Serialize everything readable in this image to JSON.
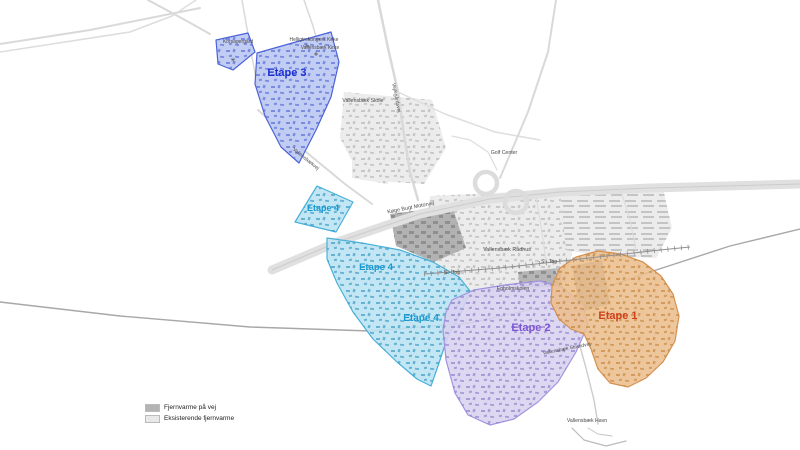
{
  "map": {
    "background": "#ffffff",
    "legend": {
      "items": [
        {
          "label": "Fjernvarme på vej",
          "color": "#b4b4b4"
        },
        {
          "label": "Eksisterende fjernvarme",
          "color": "#e9e9e9"
        }
      ]
    },
    "gray_areas": [
      {
        "name": "skole-area",
        "fill": "#ececec",
        "pattern": "patGray",
        "points": [
          [
            344,
            92
          ],
          [
            432,
            100
          ],
          [
            446,
            148
          ],
          [
            424,
            184
          ],
          [
            362,
            180
          ],
          [
            340,
            138
          ]
        ]
      },
      {
        "name": "central-area",
        "fill": "#ececec",
        "pattern": "patGray",
        "points": [
          [
            430,
            196
          ],
          [
            562,
            190
          ],
          [
            576,
            232
          ],
          [
            566,
            282
          ],
          [
            540,
            296
          ],
          [
            472,
            298
          ],
          [
            440,
            272
          ],
          [
            426,
            232
          ]
        ]
      },
      {
        "name": "east-area",
        "fill": "#ececec",
        "pattern": "patGrayRows",
        "points": [
          [
            560,
            190
          ],
          [
            662,
            184
          ],
          [
            672,
            228
          ],
          [
            656,
            258
          ],
          [
            600,
            256
          ],
          [
            566,
            250
          ]
        ]
      },
      {
        "name": "kirke-area",
        "fill": "#ededed",
        "pattern": "patGray",
        "points": [
          [
            352,
            150
          ],
          [
            392,
            160
          ],
          [
            388,
            184
          ],
          [
            352,
            178
          ]
        ]
      }
    ],
    "dark_areas": [
      {
        "name": "motorway-north-blocks",
        "fill": "#b2b2b2",
        "pattern": "patDark",
        "points": [
          [
            390,
            214
          ],
          [
            452,
            206
          ],
          [
            466,
            248
          ],
          [
            434,
            262
          ],
          [
            396,
            246
          ]
        ]
      },
      {
        "name": "orange-inner-block",
        "fill": "#9b9b9b",
        "pattern": "patDark",
        "points": [
          [
            572,
            266
          ],
          [
            602,
            260
          ],
          [
            610,
            304
          ],
          [
            580,
            312
          ]
        ]
      },
      {
        "name": "station-blocks",
        "fill": "#b5b5b5",
        "pattern": "patDark",
        "points": [
          [
            518,
            272
          ],
          [
            560,
            268
          ],
          [
            562,
            286
          ],
          [
            520,
            288
          ]
        ]
      }
    ],
    "roads": [
      {
        "name": "top-left-road-a",
        "w": 2,
        "c": "#d9d9d9",
        "pts": [
          [
            0,
            44
          ],
          [
            90,
            30
          ],
          [
            200,
            8
          ]
        ]
      },
      {
        "name": "top-left-road-b",
        "w": 2,
        "c": "#d9d9d9",
        "pts": [
          [
            148,
            0
          ],
          [
            185,
            20
          ],
          [
            210,
            34
          ]
        ]
      },
      {
        "name": "top-left-road-c",
        "w": 1.5,
        "c": "#dddddd",
        "pts": [
          [
            196,
            0
          ],
          [
            172,
            16
          ],
          [
            130,
            32
          ],
          [
            0,
            52
          ]
        ]
      },
      {
        "name": "north-road-1",
        "w": 1.5,
        "c": "#d9d9d9",
        "pts": [
          [
            242,
            0
          ],
          [
            249,
            40
          ],
          [
            258,
            90
          ],
          [
            268,
            118
          ]
        ]
      },
      {
        "name": "north-road-2",
        "w": 1.5,
        "c": "#d9d9d9",
        "pts": [
          [
            304,
            0
          ],
          [
            313,
            26
          ],
          [
            318,
            44
          ]
        ]
      },
      {
        "name": "vejlegaardsvej-road",
        "w": 2.5,
        "c": "#d9d9d9",
        "pts": [
          [
            378,
            0
          ],
          [
            388,
            48
          ],
          [
            398,
            92
          ],
          [
            404,
            135
          ],
          [
            410,
            172
          ],
          [
            418,
            200
          ]
        ]
      },
      {
        "name": "branch-east-road",
        "w": 1.5,
        "c": "#dedede",
        "pts": [
          [
            398,
            92
          ],
          [
            445,
            114
          ],
          [
            495,
            132
          ],
          [
            540,
            140
          ]
        ]
      },
      {
        "name": "vallensbaekvej-road",
        "w": 2,
        "c": "#d9d9d9",
        "pts": [
          [
            258,
            110
          ],
          [
            300,
            147
          ],
          [
            345,
            184
          ],
          [
            372,
            204
          ]
        ]
      },
      {
        "name": "motorway-band",
        "w": 9,
        "c": "#e0e0e0",
        "pts": [
          [
            272,
            270
          ],
          [
            340,
            241
          ],
          [
            420,
            214
          ],
          [
            490,
            199
          ],
          [
            560,
            192
          ],
          [
            650,
            188
          ],
          [
            800,
            184
          ]
        ]
      },
      {
        "name": "motorway-median",
        "w": 1,
        "c": "#cccccc",
        "pts": [
          [
            272,
            270
          ],
          [
            340,
            241
          ],
          [
            420,
            214
          ],
          [
            490,
            199
          ],
          [
            560,
            192
          ],
          [
            650,
            188
          ],
          [
            800,
            184
          ]
        ]
      },
      {
        "name": "interchange-north-road",
        "w": 2,
        "c": "#d9d9d9",
        "pts": [
          [
            500,
            178
          ],
          [
            528,
            112
          ],
          [
            548,
            52
          ],
          [
            556,
            0
          ]
        ]
      },
      {
        "name": "golf-road",
        "w": 1.2,
        "c": "#dddddd",
        "pts": [
          [
            497,
            170
          ],
          [
            488,
            152
          ],
          [
            470,
            140
          ],
          [
            452,
            136
          ]
        ]
      },
      {
        "name": "coast-arc-road",
        "w": 1.4,
        "c": "#a8a8a8",
        "pts": [
          [
            0,
            302
          ],
          [
            120,
            316
          ],
          [
            250,
            327
          ],
          [
            370,
            331
          ],
          [
            470,
            323
          ],
          [
            560,
            303
          ],
          [
            650,
            272
          ],
          [
            730,
            246
          ],
          [
            800,
            229
          ]
        ]
      },
      {
        "name": "harbor-road",
        "w": 1.4,
        "c": "#cccccc",
        "pts": [
          [
            556,
            270
          ],
          [
            572,
            318
          ],
          [
            586,
            368
          ],
          [
            594,
            400
          ],
          [
            598,
            424
          ]
        ]
      },
      {
        "name": "harbor-quay-a",
        "w": 1.2,
        "c": "#bbbbbb",
        "pts": [
          [
            572,
            428
          ],
          [
            584,
            440
          ],
          [
            606,
            446
          ],
          [
            626,
            441
          ]
        ]
      },
      {
        "name": "harbor-quay-b",
        "w": 1,
        "c": "#c4c4c4",
        "pts": [
          [
            588,
            428
          ],
          [
            598,
            434
          ],
          [
            612,
            436
          ]
        ]
      },
      {
        "name": "radhus-road",
        "w": 1.2,
        "c": "#dddddd",
        "pts": [
          [
            536,
            196
          ],
          [
            542,
            232
          ],
          [
            546,
            262
          ]
        ]
      },
      {
        "name": "east-road",
        "w": 1.2,
        "c": "#dddddd",
        "pts": [
          [
            620,
            188
          ],
          [
            630,
            220
          ],
          [
            636,
            250
          ]
        ]
      }
    ],
    "interchange_loops": [
      {
        "cx": 486,
        "cy": 183,
        "r": 11
      },
      {
        "cx": 516,
        "cy": 202,
        "r": 11
      }
    ],
    "railway": {
      "name": "s-tog-line",
      "pts": [
        [
          424,
          274
        ],
        [
          500,
          268
        ],
        [
          580,
          259
        ],
        [
          660,
          250
        ],
        [
          690,
          247
        ]
      ],
      "color": "#909090"
    },
    "zones": [
      {
        "name": "etape-3-north",
        "fill": "#b9c6f2",
        "stroke": "#4a63d8",
        "pattern": "patBlue",
        "points": [
          [
            216,
            40
          ],
          [
            248,
            33
          ],
          [
            255,
            52
          ],
          [
            233,
            70
          ],
          [
            218,
            64
          ]
        ],
        "labels": []
      },
      {
        "name": "etape-3",
        "fill": "#b9c6f2",
        "stroke": "#4a63d8",
        "pattern": "patBlue",
        "points": [
          [
            257,
            53
          ],
          [
            331,
            32
          ],
          [
            339,
            62
          ],
          [
            331,
            97
          ],
          [
            316,
            130
          ],
          [
            299,
            163
          ],
          [
            281,
            147
          ],
          [
            265,
            116
          ],
          [
            255,
            84
          ]
        ],
        "labels": [
          {
            "text": "Etape 3",
            "x": 287,
            "y": 76,
            "size": 11,
            "color": "#1b2fd0"
          }
        ]
      },
      {
        "name": "etape-4-west",
        "fill": "#b9e3f3",
        "stroke": "#49b0d8",
        "pattern": "patCyan",
        "points": [
          [
            317,
            186
          ],
          [
            353,
            202
          ],
          [
            336,
            232
          ],
          [
            295,
            222
          ]
        ],
        "labels": [
          {
            "text": "Etape 4",
            "x": 323,
            "y": 211,
            "size": 9,
            "color": "#1899d1"
          }
        ]
      },
      {
        "name": "etape-4-main",
        "fill": "#b9e3f3",
        "stroke": "#49b0d8",
        "pattern": "patCyan",
        "points": [
          [
            327,
            238
          ],
          [
            362,
            243
          ],
          [
            400,
            250
          ],
          [
            433,
            262
          ],
          [
            459,
            277
          ],
          [
            470,
            291
          ],
          [
            461,
            313
          ],
          [
            447,
            339
          ],
          [
            439,
            363
          ],
          [
            431,
            386
          ],
          [
            417,
            379
          ],
          [
            397,
            362
          ],
          [
            373,
            339
          ],
          [
            353,
            312
          ],
          [
            337,
            283
          ],
          [
            327,
            259
          ]
        ],
        "labels": [
          {
            "text": "Etape 4",
            "x": 376,
            "y": 270,
            "size": 9.5,
            "color": "#1899d1"
          },
          {
            "text": "Etape 4",
            "x": 421,
            "y": 321,
            "size": 10,
            "color": "#1899d1"
          }
        ]
      },
      {
        "name": "etape-2",
        "fill": "#d8d2f0",
        "stroke": "#a193e0",
        "pattern": "patPurple",
        "points": [
          [
            452,
            300
          ],
          [
            474,
            290
          ],
          [
            505,
            285
          ],
          [
            540,
            281
          ],
          [
            562,
            287
          ],
          [
            583,
            305
          ],
          [
            588,
            325
          ],
          [
            576,
            352
          ],
          [
            558,
            382
          ],
          [
            538,
            402
          ],
          [
            514,
            419
          ],
          [
            490,
            425
          ],
          [
            468,
            415
          ],
          [
            455,
            393
          ],
          [
            446,
            360
          ],
          [
            443,
            330
          ],
          [
            446,
            312
          ]
        ],
        "labels": [
          {
            "text": "Etape 2",
            "x": 531,
            "y": 331,
            "size": 11,
            "color": "#7d55d6"
          }
        ]
      },
      {
        "name": "etape-1",
        "fill": "#ecbe8e",
        "stroke": "#d6904e",
        "pattern": "patOrange",
        "points": [
          [
            552,
            286
          ],
          [
            560,
            268
          ],
          [
            576,
            257
          ],
          [
            598,
            251
          ],
          [
            621,
            254
          ],
          [
            643,
            262
          ],
          [
            661,
            276
          ],
          [
            673,
            294
          ],
          [
            679,
            316
          ],
          [
            675,
            341
          ],
          [
            663,
            362
          ],
          [
            646,
            378
          ],
          [
            628,
            387
          ],
          [
            610,
            383
          ],
          [
            598,
            369
          ],
          [
            591,
            349
          ],
          [
            584,
            334
          ],
          [
            571,
            329
          ],
          [
            559,
            319
          ],
          [
            551,
            303
          ]
        ],
        "labels": [
          {
            "text": "Etape 1",
            "x": 618,
            "y": 319,
            "size": 11,
            "color": "#d0401c"
          }
        ]
      }
    ],
    "place_labels": [
      {
        "text": "Korsagergård",
        "x": 238,
        "y": 43,
        "size": 5
      },
      {
        "text": "Helligtrekongers Kirke",
        "x": 314,
        "y": 41,
        "size": 5
      },
      {
        "text": "Vallensbæk Kirke",
        "x": 320,
        "y": 49,
        "size": 5
      },
      {
        "text": "Vallensbæk Skole",
        "x": 363,
        "y": 102,
        "size": 5.2
      },
      {
        "text": "Golf Center",
        "x": 504,
        "y": 154,
        "size": 5.2
      },
      {
        "text": "Køge Bugt Motorvej",
        "x": 411,
        "y": 209,
        "size": 5.4,
        "rotate": -11
      },
      {
        "text": "Vallensbæk Rådhus",
        "x": 507,
        "y": 251,
        "size": 5.4
      },
      {
        "text": "S - Tog",
        "x": 452,
        "y": 274,
        "size": 5
      },
      {
        "text": "S - Tog",
        "x": 549,
        "y": 263,
        "size": 5
      },
      {
        "text": "Egholmskolen",
        "x": 513,
        "y": 290,
        "size": 5.2
      },
      {
        "text": "Vallensbæk Strandvej",
        "x": 567,
        "y": 350,
        "size": 5,
        "rotate": -11
      },
      {
        "text": "Vallensbæk Havn",
        "x": 587,
        "y": 422,
        "size": 5.2
      },
      {
        "text": "Vallensbækvej",
        "x": 305,
        "y": 160,
        "size": 5,
        "rotate": 39
      },
      {
        "text": "Vejlegårdsvej",
        "x": 395,
        "y": 98,
        "size": 5,
        "rotate": 79
      }
    ],
    "markers": [
      {
        "type": "church",
        "x": 307,
        "y": 46
      },
      {
        "type": "church",
        "x": 316,
        "y": 54
      },
      {
        "type": "mill",
        "x": 233,
        "y": 62
      }
    ]
  }
}
